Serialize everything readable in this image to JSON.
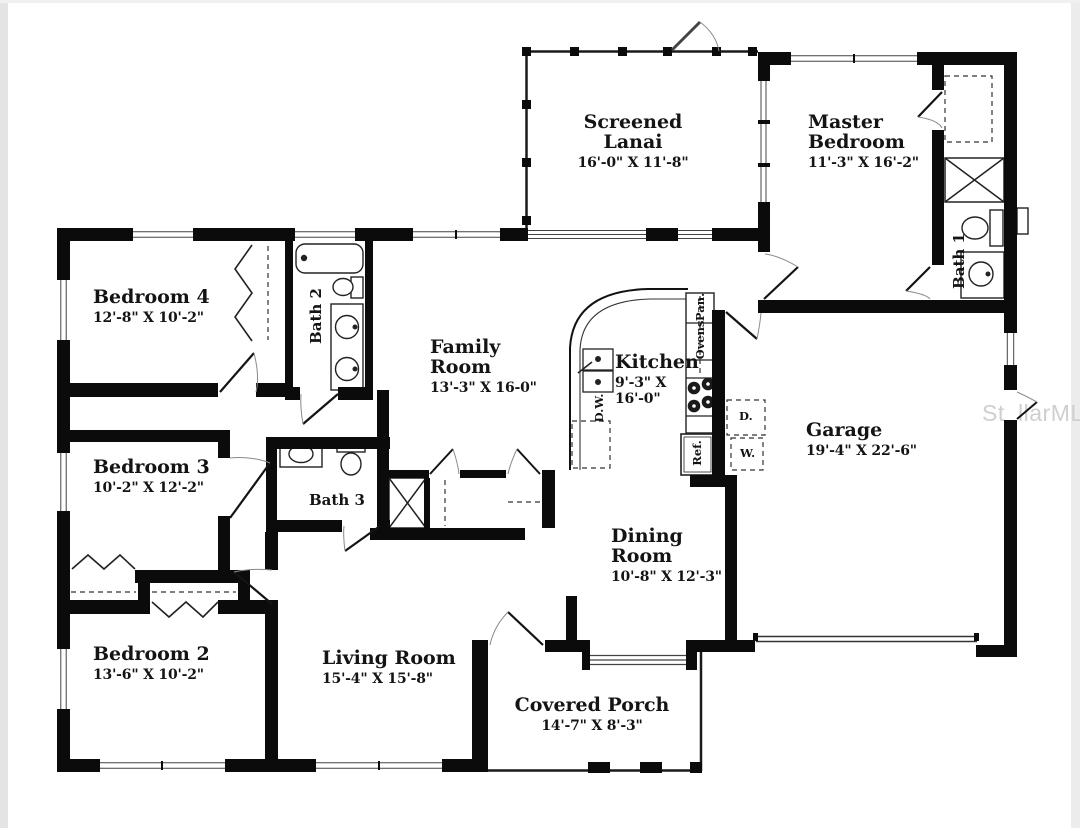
{
  "watermark": "StellarMLS",
  "rooms": {
    "lanai": {
      "line1": "Screened",
      "line2": "Lanai",
      "dims": "16'-0\" X 11'-8\""
    },
    "master": {
      "line1": "Master",
      "line2": "Bedroom",
      "dims": "11'-3\" X 16'-2\""
    },
    "bedroom4": {
      "name": "Bedroom 4",
      "dims": "12'-8\" X 10'-2\""
    },
    "family": {
      "line1": "Family",
      "line2": "Room",
      "dims": "13'-3\" X 16-0\""
    },
    "kitchen": {
      "name": "Kitchen",
      "dims_line1": "9'-3\" X",
      "dims_line2": "16'-0\""
    },
    "garage": {
      "name": "Garage",
      "dims": "19'-4\" X 22'-6\""
    },
    "bedroom3": {
      "name": "Bedroom 3",
      "dims": "10'-2\" X 12'-2\""
    },
    "dining": {
      "line1": "Dining",
      "line2": "Room",
      "dims": "10'-8\" X 12'-3\""
    },
    "bedroom2": {
      "name": "Bedroom 2",
      "dims": "13'-6\" X 10'-2\""
    },
    "living": {
      "name": "Living Room",
      "dims": "15'-4\" X 15'-8\""
    },
    "porch": {
      "name": "Covered Porch",
      "dims": "14'-7\" X 8'-3\""
    }
  },
  "bathrooms": {
    "bath1": "Bath 1",
    "bath2": "Bath 2",
    "bath3": "Bath 3"
  },
  "appliances": {
    "pantry": "Pan.",
    "ovens": "Ovens",
    "refrigerator": "Ref.",
    "dishwasher": "D.W.",
    "dryer": "D.",
    "washer": "W."
  },
  "colors": {
    "wall": "#0b0b0b",
    "line": "#333333",
    "watermark": "#cfcfcf"
  }
}
